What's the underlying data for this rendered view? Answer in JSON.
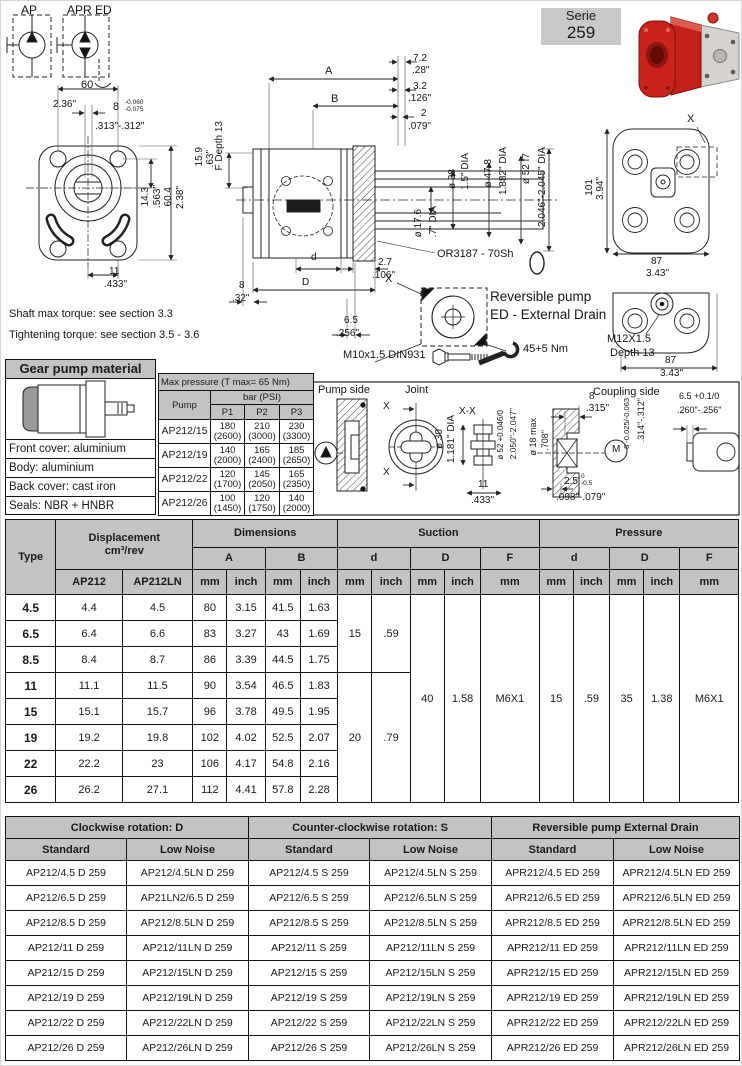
{
  "header": {
    "serie_label": "Serie",
    "serie_number": "259"
  },
  "notes": {
    "shaft_torque": "Shaft max torque: see section 3.3",
    "tightening_torque": "Tightening torque: see section 3.5 - 3.6"
  },
  "material_box": {
    "title": "Gear pump material",
    "rows": [
      "Front cover: aluminium",
      "Body: aluminium",
      "Back cover: cast iron",
      "Seals: NBR + HNBR"
    ]
  },
  "pressure_table": {
    "title": "Max pressure (T max= 65 Nm)",
    "pump_col": "Pump",
    "bar_psi": "bar (PSI)",
    "p_cols": [
      "P1",
      "P2",
      "P3"
    ],
    "rows": [
      {
        "pump": "AP212/15",
        "p1": "180\n(2600)",
        "p2": "210\n(3000)",
        "p3": "230\n(3300)"
      },
      {
        "pump": "AP212/19",
        "p1": "140\n(2000)",
        "p2": "165\n(2400)",
        "p3": "185\n(2650)"
      },
      {
        "pump": "AP212/22",
        "p1": "120\n(1700)",
        "p2": "145\n(2050)",
        "p3": "165\n(2350)"
      },
      {
        "pump": "AP212/26",
        "p1": "100\n(1450)",
        "p2": "120\n(1750)",
        "p3": "140\n(2000)"
      }
    ]
  },
  "joint_panel": {
    "pump_side": "Pump side",
    "joint": "Joint",
    "coupling_side": "Coupling side"
  },
  "dim_table": {
    "headers": {
      "type": "Type",
      "displacement": "Displacement\ncm³/rev",
      "dimensions": "Dimensions",
      "suction": "Suction",
      "pressure": "Pressure",
      "ap212": "AP212",
      "ap212ln": "AP212LN",
      "a": "A",
      "b": "B",
      "d": "d",
      "dd": "D",
      "f": "F",
      "mm": "mm",
      "inch": "inch"
    },
    "rows": [
      {
        "type": "4.5",
        "ap212": "4.4",
        "ap212ln": "4.5",
        "a_mm": "80",
        "a_inch": "3.15",
        "b_mm": "41.5",
        "b_inch": "1.63"
      },
      {
        "type": "6.5",
        "ap212": "6.4",
        "ap212ln": "6.6",
        "a_mm": "83",
        "a_inch": "3.27",
        "b_mm": "43",
        "b_inch": "1.69"
      },
      {
        "type": "8.5",
        "ap212": "8.4",
        "ap212ln": "8.7",
        "a_mm": "86",
        "a_inch": "3.39",
        "b_mm": "44.5",
        "b_inch": "1.75"
      },
      {
        "type": "11",
        "ap212": "11.1",
        "ap212ln": "11.5",
        "a_mm": "90",
        "a_inch": "3.54",
        "b_mm": "46.5",
        "b_inch": "1.83"
      },
      {
        "type": "15",
        "ap212": "15.1",
        "ap212ln": "15.7",
        "a_mm": "96",
        "a_inch": "3.78",
        "b_mm": "49.5",
        "b_inch": "1.95"
      },
      {
        "type": "19",
        "ap212": "19.2",
        "ap212ln": "19.8",
        "a_mm": "102",
        "a_inch": "4.02",
        "b_mm": "52.5",
        "b_inch": "2.07"
      },
      {
        "type": "22",
        "ap212": "22.2",
        "ap212ln": "23",
        "a_mm": "106",
        "a_inch": "4.17",
        "b_mm": "54.8",
        "b_inch": "2.16"
      },
      {
        "type": "26",
        "ap212": "26.2",
        "ap212ln": "27.1",
        "a_mm": "112",
        "a_inch": "4.41",
        "b_mm": "57.8",
        "b_inch": "2.28"
      }
    ],
    "merged": {
      "suction_d": [
        {
          "row": 0,
          "span": 3,
          "mm": "15",
          "inch": ".59"
        },
        {
          "row": 3,
          "span": 5,
          "mm": "20",
          "inch": ".79"
        }
      ],
      "suction_D": {
        "span": 8,
        "mm": "40",
        "inch": "1.58"
      },
      "suction_F": {
        "span": 8,
        "mm": "M6X1"
      },
      "pressure_d": {
        "span": 8,
        "mm": "15",
        "inch": ".59"
      },
      "pressure_D": {
        "span": 8,
        "mm": "35",
        "inch": "1.38"
      },
      "pressure_F": {
        "span": 8,
        "mm": "M6X1"
      }
    }
  },
  "rotation_table": {
    "groups": [
      "Clockwise rotation: D",
      "Counter-clockwise rotation: S",
      "Reversible pump External Drain"
    ],
    "sub": [
      "Standard",
      "Low Noise"
    ],
    "rows": [
      [
        "AP212/4.5 D 259",
        "AP212/4.5LN D 259",
        "AP212/4.5 S 259",
        "AP212/4.5LN S 259",
        "APR212/4.5 ED 259",
        "APR212/4.5LN ED 259"
      ],
      [
        "AP212/6.5 D 259",
        "AP21LN2/6.5 D 259",
        "AP212/6.5 S 259",
        "AP212/6.5LN S 259",
        "APR212/6.5 ED 259",
        "APR212/6.5LN ED 259"
      ],
      [
        "AP212/8.5 D 259",
        "AP212/8.5LN D 259",
        "AP212/8.5 S 259",
        "AP212/8.5LN S 259",
        "APR212/8.5 ED 259",
        "APR212/8.5LN ED 259"
      ],
      [
        "AP212/11 D 259",
        "AP212/11LN D 259",
        "AP212/11 S 259",
        "AP212/11LN S 259",
        "APR212/11 ED 259",
        "APR212/11LN ED 259"
      ],
      [
        "AP212/15 D 259",
        "AP212/15LN D 259",
        "AP212/15 S 259",
        "AP212/15LN S 259",
        "APR212/15 ED 259",
        "APR212/15LN ED 259"
      ],
      [
        "AP212/19 D 259",
        "AP212/19LN D 259",
        "AP212/19 S 259",
        "AP212/19LN S 259",
        "APR212/19 ED 259",
        "APR212/19LN ED 259"
      ],
      [
        "AP212/22 D 259",
        "AP212/22LN D 259",
        "AP212/22 S 259",
        "AP212/22LN S 259",
        "APR212/22 ED 259",
        "APR212/22LN ED 259"
      ],
      [
        "AP212/26 D 259",
        "AP212/26LN D 259",
        "AP212/26 S 259",
        "AP212/26LN S 259",
        "APR212/26 ED 259",
        "APR212/26LN ED 259"
      ]
    ]
  },
  "colors": {
    "header_gray": "#c3c3c3",
    "pump_red": "#c32017",
    "line": "#222222"
  },
  "annotations": [
    {
      "t": "AP",
      "x": 20,
      "y": 3,
      "fs": 12
    },
    {
      "t": "APR ED",
      "x": 66,
      "y": 3,
      "fs": 12
    },
    {
      "t": "60",
      "x": 80,
      "y": 79,
      "fs": 11
    },
    {
      "t": "2.36\"",
      "x": 52,
      "y": 99
    },
    {
      "t": "8",
      "x": 112,
      "y": 101,
      "fs": 11
    },
    {
      "t": "-0.060\n-0.075",
      "x": 124,
      "y": 98,
      "fs": 6.5
    },
    {
      "t": ".313\"-.312\"",
      "x": 94,
      "y": 121
    },
    {
      "t": "14.3",
      "x": 140,
      "y": 186,
      "v": 1
    },
    {
      "t": ".563\"",
      "x": 152,
      "y": 184,
      "v": 1
    },
    {
      "t": "60.4",
      "x": 163,
      "y": 186,
      "v": 1
    },
    {
      "t": "2.38\"",
      "x": 175,
      "y": 185,
      "v": 1
    },
    {
      "t": "11",
      "x": 108,
      "y": 266
    },
    {
      "t": ".433\"",
      "x": 103,
      "y": 279
    },
    {
      "t": "Shaft max torque: see section 3.3",
      "x": 8,
      "y": 308,
      "fs": 11
    },
    {
      "t": "Tightening torque: see section 3.5 - 3.6",
      "x": 8,
      "y": 329,
      "fs": 11
    },
    {
      "t": "A",
      "x": 324,
      "y": 65,
      "fs": 11
    },
    {
      "t": "B",
      "x": 330,
      "y": 93,
      "fs": 11
    },
    {
      "t": "7.2",
      "x": 412,
      "y": 53
    },
    {
      "t": ".28\"",
      "x": 411,
      "y": 65
    },
    {
      "t": "3.2",
      "x": 412,
      "y": 81
    },
    {
      "t": ".126\"",
      "x": 407,
      "y": 93
    },
    {
      "t": "2",
      "x": 420,
      "y": 108
    },
    {
      "t": ".079\"",
      "x": 407,
      "y": 121
    },
    {
      "t": "15.9",
      "x": 194,
      "y": 146,
      "v": 1
    },
    {
      "t": ".63\"",
      "x": 205,
      "y": 149,
      "v": 1
    },
    {
      "t": "F Depth 13",
      "x": 214,
      "y": 120,
      "v": 1
    },
    {
      "t": "ø 38",
      "x": 447,
      "y": 168,
      "v": 1
    },
    {
      "t": "1.5\" DIA",
      "x": 460,
      "y": 152,
      "v": 1
    },
    {
      "t": "ø 47.8",
      "x": 483,
      "y": 158,
      "v": 1
    },
    {
      "t": "1.882\" DIA",
      "x": 498,
      "y": 146,
      "v": 1
    },
    {
      "t": "ø 52 f7",
      "x": 521,
      "y": 152,
      "v": 1
    },
    {
      "t": "2.046\"-2.045\" DIA",
      "x": 537,
      "y": 146,
      "v": 1
    },
    {
      "t": "ø 17.6",
      "x": 413,
      "y": 208,
      "v": 1
    },
    {
      "t": ".7\" DIA",
      "x": 428,
      "y": 205,
      "v": 1
    },
    {
      "t": "OR3187 - 70Sh",
      "x": 436,
      "y": 248,
      "fs": 11
    },
    {
      "t": "2.7",
      "x": 377,
      "y": 257
    },
    {
      "t": ".106\"",
      "x": 371,
      "y": 270
    },
    {
      "t": "8",
      "x": 238,
      "y": 280
    },
    {
      "t": ".32\"",
      "x": 231,
      "y": 293
    },
    {
      "t": "d",
      "x": 310,
      "y": 252
    },
    {
      "t": "D",
      "x": 301,
      "y": 277
    },
    {
      "t": "6.5",
      "x": 343,
      "y": 315
    },
    {
      "t": ".256\"",
      "x": 335,
      "y": 328
    },
    {
      "t": "M10x1.5 DIN931",
      "x": 342,
      "y": 349,
      "fs": 11
    },
    {
      "t": "45+5 Nm",
      "x": 522,
      "y": 343,
      "fs": 11
    },
    {
      "t": "X",
      "x": 384,
      "y": 273,
      "fs": 11
    },
    {
      "t": "Reversible pump",
      "x": 489,
      "y": 289,
      "fs": 13.5
    },
    {
      "t": "ED - External Drain",
      "x": 489,
      "y": 307,
      "fs": 13.5
    },
    {
      "t": "X",
      "x": 686,
      "y": 113,
      "fs": 11
    },
    {
      "t": "101",
      "x": 584,
      "y": 178,
      "v": 1
    },
    {
      "t": "3.94\"",
      "x": 595,
      "y": 176,
      "v": 1
    },
    {
      "t": "87",
      "x": 650,
      "y": 256
    },
    {
      "t": "3.43\"",
      "x": 645,
      "y": 268
    },
    {
      "t": "M12X1.5",
      "x": 606,
      "y": 333,
      "fs": 11
    },
    {
      "t": "Depth 13",
      "x": 609,
      "y": 347,
      "fs": 11
    },
    {
      "t": "87",
      "x": 664,
      "y": 355
    },
    {
      "t": "3.43\"",
      "x": 659,
      "y": 368
    },
    {
      "t": "Pump side",
      "x": 317,
      "y": 384,
      "fs": 11
    },
    {
      "t": "Joint",
      "x": 404,
      "y": 384,
      "fs": 11
    },
    {
      "t": "Coupling side",
      "x": 592,
      "y": 386,
      "fs": 11
    },
    {
      "t": "X",
      "x": 382,
      "y": 401
    },
    {
      "t": "X",
      "x": 382,
      "y": 467
    },
    {
      "t": "X-X",
      "x": 458,
      "y": 406
    },
    {
      "t": "ø 30",
      "x": 434,
      "y": 428,
      "v": 1
    },
    {
      "t": "1.181\" DIA",
      "x": 446,
      "y": 414,
      "v": 1
    },
    {
      "t": "ø 52 +0.046/0",
      "x": 496,
      "y": 409,
      "v": 1,
      "fs": 8
    },
    {
      "t": "2.050\"-2.047\"",
      "x": 508,
      "y": 407,
      "v": 1,
      "fs": 8.5
    },
    {
      "t": "ø 18 max",
      "x": 528,
      "y": 417,
      "v": 1,
      "fs": 9
    },
    {
      "t": ".708\"",
      "x": 540,
      "y": 429,
      "v": 1,
      "fs": 9
    },
    {
      "t": "11",
      "x": 477,
      "y": 479
    },
    {
      "t": ".433\"",
      "x": 470,
      "y": 495
    },
    {
      "t": "8",
      "x": 588,
      "y": 391
    },
    {
      "t": ".315\"",
      "x": 585,
      "y": 403
    },
    {
      "t": "8 -0.025/-0.063",
      "x": 622,
      "y": 397,
      "v": 1,
      "fs": 7.5
    },
    {
      "t": ".314\"-.312\"",
      "x": 636,
      "y": 397,
      "v": 1,
      "fs": 9
    },
    {
      "t": "6.5 +0.1/0",
      "x": 678,
      "y": 391,
      "fs": 9
    },
    {
      "t": ".260\"-.256\"",
      "x": 676,
      "y": 405,
      "fs": 9
    },
    {
      "t": "2.5",
      "x": 563,
      "y": 476
    },
    {
      "t": "0\n-0.5",
      "x": 580,
      "y": 472,
      "fs": 6.5
    },
    {
      "t": ".098\"-.079\"",
      "x": 555,
      "y": 492
    },
    {
      "t": "M",
      "x": 611,
      "y": 444,
      "fs": 10
    }
  ]
}
